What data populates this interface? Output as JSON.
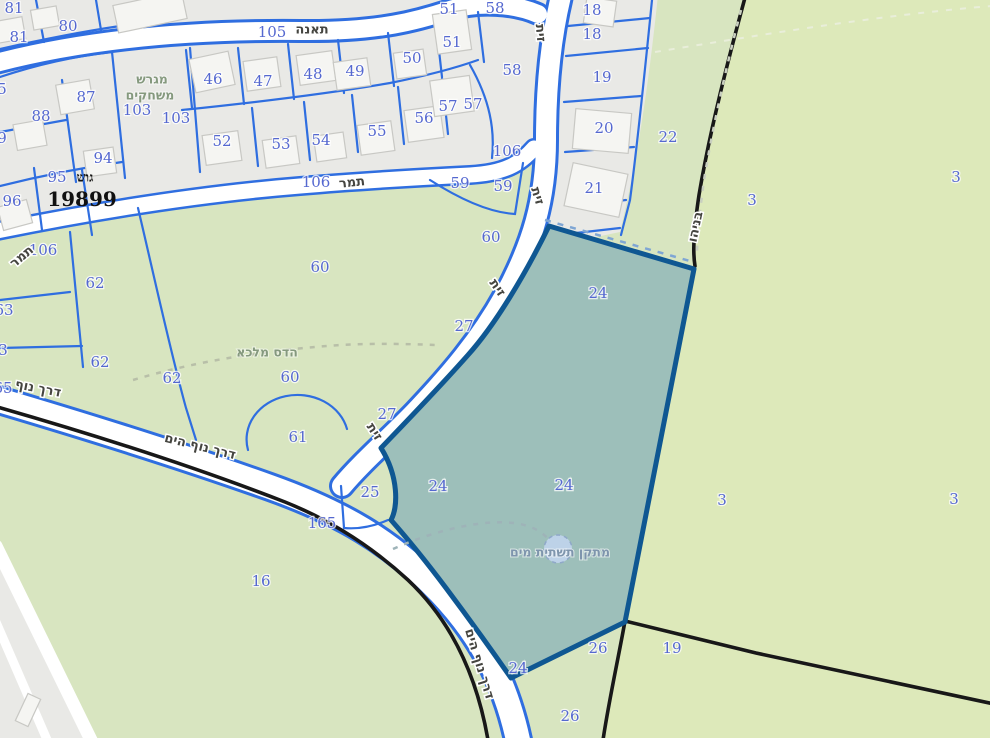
{
  "map": {
    "block": {
      "prefix": "גוש",
      "number": "19899"
    },
    "selected_parcel": {
      "number": "24",
      "block": "19899"
    },
    "street_names": [
      "תאנה",
      "תמר",
      "זית",
      "דרך נוף הים",
      "בניהו"
    ],
    "place_names": {
      "playground_line1": "מגרש",
      "playground_line2": "משחקים",
      "trail": "הדס מלכא",
      "water_facility": "מתקן תשתית מים"
    },
    "labels": [
      {
        "t": "81",
        "x": 14,
        "y": 8,
        "c": "num"
      },
      {
        "t": "80",
        "x": 68,
        "y": 26,
        "c": "num"
      },
      {
        "t": "81",
        "x": 19,
        "y": 37,
        "c": "num"
      },
      {
        "t": "5",
        "x": 2,
        "y": 89,
        "c": "num"
      },
      {
        "t": "9",
        "x": 2,
        "y": 138,
        "c": "num"
      },
      {
        "t": "105",
        "x": 272,
        "y": 32,
        "c": "num"
      },
      {
        "t": "46",
        "x": 213,
        "y": 79,
        "c": "num"
      },
      {
        "t": "47",
        "x": 263,
        "y": 81,
        "c": "num"
      },
      {
        "t": "48",
        "x": 313,
        "y": 74,
        "c": "num"
      },
      {
        "t": "49",
        "x": 355,
        "y": 71,
        "c": "num"
      },
      {
        "t": "50",
        "x": 412,
        "y": 58,
        "c": "num"
      },
      {
        "t": "51",
        "x": 449,
        "y": 9,
        "c": "num"
      },
      {
        "t": "51",
        "x": 452,
        "y": 42,
        "c": "num"
      },
      {
        "t": "58",
        "x": 495,
        "y": 8,
        "c": "num"
      },
      {
        "t": "58",
        "x": 512,
        "y": 70,
        "c": "num"
      },
      {
        "t": "57",
        "x": 448,
        "y": 106,
        "c": "num"
      },
      {
        "t": "57",
        "x": 473,
        "y": 104,
        "c": "num"
      },
      {
        "t": "56",
        "x": 424,
        "y": 118,
        "c": "num"
      },
      {
        "t": "55",
        "x": 377,
        "y": 131,
        "c": "num"
      },
      {
        "t": "54",
        "x": 321,
        "y": 140,
        "c": "num"
      },
      {
        "t": "53",
        "x": 281,
        "y": 144,
        "c": "num"
      },
      {
        "t": "52",
        "x": 222,
        "y": 141,
        "c": "num"
      },
      {
        "t": "87",
        "x": 86,
        "y": 97,
        "c": "num"
      },
      {
        "t": "88",
        "x": 41,
        "y": 116,
        "c": "num"
      },
      {
        "t": "94",
        "x": 103,
        "y": 158,
        "c": "num"
      },
      {
        "t": "95",
        "x": 57,
        "y": 177,
        "c": "num"
      },
      {
        "t": "96",
        "x": 12,
        "y": 201,
        "c": "num"
      },
      {
        "t": "103",
        "x": 137,
        "y": 110,
        "c": "num"
      },
      {
        "t": "103",
        "x": 176,
        "y": 118,
        "c": "num"
      },
      {
        "t": "106",
        "x": 316,
        "y": 182,
        "c": "num"
      },
      {
        "t": "106",
        "x": 507,
        "y": 151,
        "c": "num"
      },
      {
        "t": "106",
        "x": 43,
        "y": 250,
        "c": "num"
      },
      {
        "t": "59",
        "x": 460,
        "y": 183,
        "c": "num"
      },
      {
        "t": "59",
        "x": 503,
        "y": 186,
        "c": "num"
      },
      {
        "t": "60",
        "x": 491,
        "y": 237,
        "c": "num"
      },
      {
        "t": "60",
        "x": 320,
        "y": 267,
        "c": "num"
      },
      {
        "t": "60",
        "x": 290,
        "y": 377,
        "c": "num"
      },
      {
        "t": "62",
        "x": 95,
        "y": 283,
        "c": "num"
      },
      {
        "t": "62",
        "x": 100,
        "y": 362,
        "c": "num"
      },
      {
        "t": "62",
        "x": 172,
        "y": 378,
        "c": "num"
      },
      {
        "t": "63",
        "x": 4,
        "y": 310,
        "c": "num"
      },
      {
        "t": "3",
        "x": 3,
        "y": 350,
        "c": "num"
      },
      {
        "t": "65",
        "x": 3,
        "y": 388,
        "c": "num"
      },
      {
        "t": "61",
        "x": 298,
        "y": 437,
        "c": "num"
      },
      {
        "t": "27",
        "x": 464,
        "y": 326,
        "c": "num"
      },
      {
        "t": "27",
        "x": 387,
        "y": 414,
        "c": "num"
      },
      {
        "t": "25",
        "x": 370,
        "y": 492,
        "c": "num"
      },
      {
        "t": "165",
        "x": 322,
        "y": 523,
        "c": "num"
      },
      {
        "t": "16",
        "x": 261,
        "y": 581,
        "c": "num"
      },
      {
        "t": "24",
        "x": 598,
        "y": 293,
        "c": "num"
      },
      {
        "t": "24",
        "x": 438,
        "y": 486,
        "c": "num"
      },
      {
        "t": "24",
        "x": 564,
        "y": 485,
        "c": "num"
      },
      {
        "t": "24",
        "x": 518,
        "y": 668,
        "c": "num"
      },
      {
        "t": "22",
        "x": 668,
        "y": 137,
        "c": "num"
      },
      {
        "t": "3",
        "x": 752,
        "y": 200,
        "c": "num"
      },
      {
        "t": "3",
        "x": 956,
        "y": 177,
        "c": "num"
      },
      {
        "t": "3",
        "x": 722,
        "y": 500,
        "c": "num"
      },
      {
        "t": "3",
        "x": 954,
        "y": 499,
        "c": "num"
      },
      {
        "t": "19",
        "x": 672,
        "y": 648,
        "c": "num"
      },
      {
        "t": "26",
        "x": 598,
        "y": 648,
        "c": "num"
      },
      {
        "t": "26",
        "x": 570,
        "y": 716,
        "c": "num"
      },
      {
        "t": "18",
        "x": 592,
        "y": 10,
        "c": "num"
      },
      {
        "t": "18",
        "x": 592,
        "y": 34,
        "c": "num"
      },
      {
        "t": "19",
        "x": 602,
        "y": 77,
        "c": "num"
      },
      {
        "t": "20",
        "x": 604,
        "y": 128,
        "c": "num"
      },
      {
        "t": "21",
        "x": 594,
        "y": 188,
        "c": "num"
      },
      {
        "t": "תאנה",
        "x": 312,
        "y": 30,
        "c": "street",
        "r": 0
      },
      {
        "t": "תמר",
        "x": 352,
        "y": 183,
        "c": "street",
        "r": -6
      },
      {
        "t": "תמר",
        "x": 22,
        "y": 257,
        "c": "street",
        "r": -40
      },
      {
        "t": "זית",
        "x": 540,
        "y": 33,
        "c": "street",
        "r": 85
      },
      {
        "t": "זית",
        "x": 537,
        "y": 196,
        "c": "street",
        "r": 73
      },
      {
        "t": "זית",
        "x": 497,
        "y": 288,
        "c": "street",
        "r": 55
      },
      {
        "t": "זית",
        "x": 374,
        "y": 432,
        "c": "street",
        "r": 57
      },
      {
        "t": "דרך נוף הים",
        "x": 200,
        "y": 447,
        "c": "street",
        "r": 14
      },
      {
        "t": "דרך נוף",
        "x": 38,
        "y": 389,
        "c": "street",
        "r": 11
      },
      {
        "t": "דרך נוף הים",
        "x": 479,
        "y": 664,
        "c": "street",
        "r": 73
      },
      {
        "t": "בניהו",
        "x": 696,
        "y": 227,
        "c": "street",
        "r": -78
      },
      {
        "t": "מגרש",
        "x": 152,
        "y": 79,
        "c": "area"
      },
      {
        "t": "משחקים",
        "x": 150,
        "y": 95,
        "c": "area"
      },
      {
        "t": "הדס מלכא",
        "x": 267,
        "y": 352,
        "c": "area"
      },
      {
        "t": "מתקן תשתית מים",
        "x": 560,
        "y": 552,
        "c": "water"
      },
      {
        "t": "גוש",
        "x": 85,
        "y": 178,
        "c": "gush1"
      },
      {
        "t": "19899",
        "x": 82,
        "y": 199,
        "c": "gush2"
      }
    ]
  },
  "colors": {
    "green": "#d8e5c0",
    "green2": "#dde9ba",
    "gray": "#e9e9e6",
    "road": "#ffffff",
    "blue": "#2f6ee0",
    "navy": "#0f5792",
    "teal": "#9dbfba",
    "kblack": "#181818",
    "numblue": "#5568d0",
    "street": "#454540",
    "areagreen": "#85997e",
    "waterfill": "#bdd2e8",
    "watertext": "#7e95ad"
  }
}
